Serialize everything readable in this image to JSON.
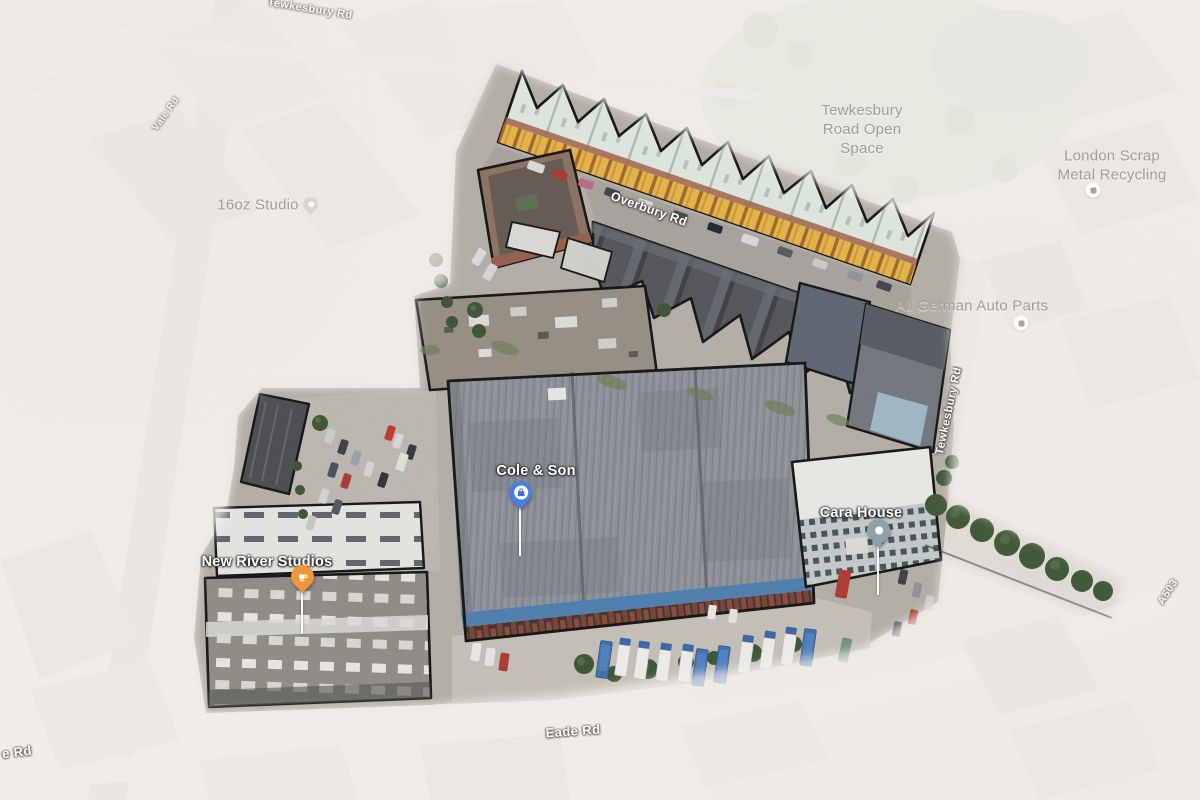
{
  "map": {
    "site_pois": {
      "cole_and_son": {
        "label": "Cole & Son",
        "marker_color": "#4a7de4",
        "marker_icon": "shopping-bag"
      },
      "cara_house": {
        "label": "Cara House",
        "marker_color": "#8fa0ad",
        "marker_icon": "dot"
      },
      "new_river_studios": {
        "label": "New River Studios",
        "marker_color": "#ef9636",
        "marker_icon": "coffee-cup"
      }
    },
    "pois": {
      "open_space": {
        "line1": "Tewkesbury",
        "line2": "Road Open",
        "line3": "Space"
      },
      "scrap_metal": {
        "line1": "London Scrap",
        "line2": "Metal Recycling",
        "marker_icon": "circle"
      },
      "auto_parts": {
        "label": "All German Auto Parts",
        "marker_icon": "circle"
      },
      "studio_16oz": {
        "label": "16oz Studio",
        "marker_icon": "pin"
      }
    },
    "roads": {
      "overbury": "Overbury Rd",
      "tewkesbury_top": "Tewkesbury Rd",
      "tewkesbury_right": "Tewkesbury Rd",
      "eade": "Eade Rd",
      "eade_partial": "e Rd",
      "vale": "Vale Rd",
      "a503": "A503"
    },
    "palette": {
      "site_outline": "#151515",
      "terrace_roof": "#dde6dd",
      "terrace_facade": "#e3b345",
      "warehouse_roof": "#8e9298",
      "warehouse_trim_blue": "#4d7fad",
      "marker_blue": "#4a7de4",
      "marker_orange": "#ef9636",
      "marker_slate": "#8fa0ad",
      "faded_overlay": "#f4f1ed"
    }
  }
}
